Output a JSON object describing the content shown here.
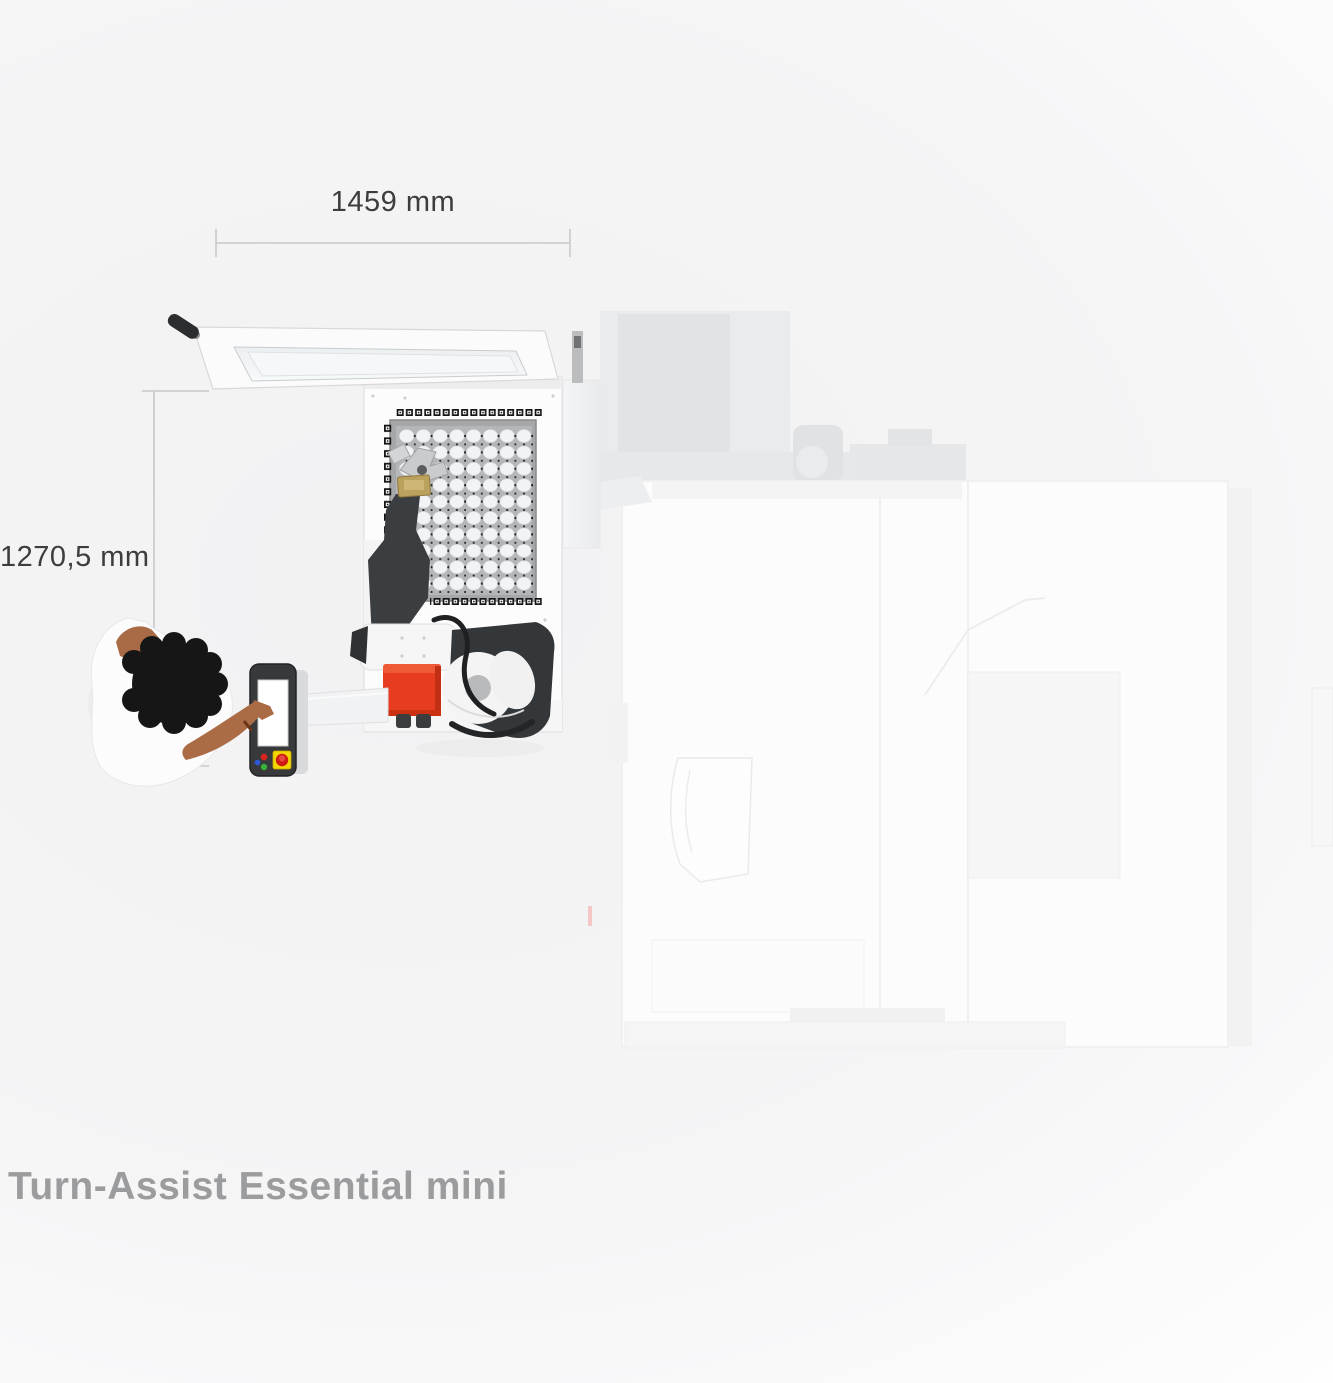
{
  "annotations": {
    "width_dimension": "1459 mm",
    "height_dimension": "1270,5 mm"
  },
  "caption": {
    "title": "Turn-Assist Essential mini"
  },
  "palette": {
    "robot_base_red": "#e73c1f",
    "estop_yellow": "#f3d500",
    "estop_red": "#d01910",
    "pendant_frame_gray": "#37393b",
    "grid_plate_gray": "#b4b5b7",
    "dimension_line_gray": "#c8c9ca",
    "annotation_text": "#3d3d3d",
    "caption_text": "#9b9c9e",
    "background_tint": "#f2f2f3"
  }
}
